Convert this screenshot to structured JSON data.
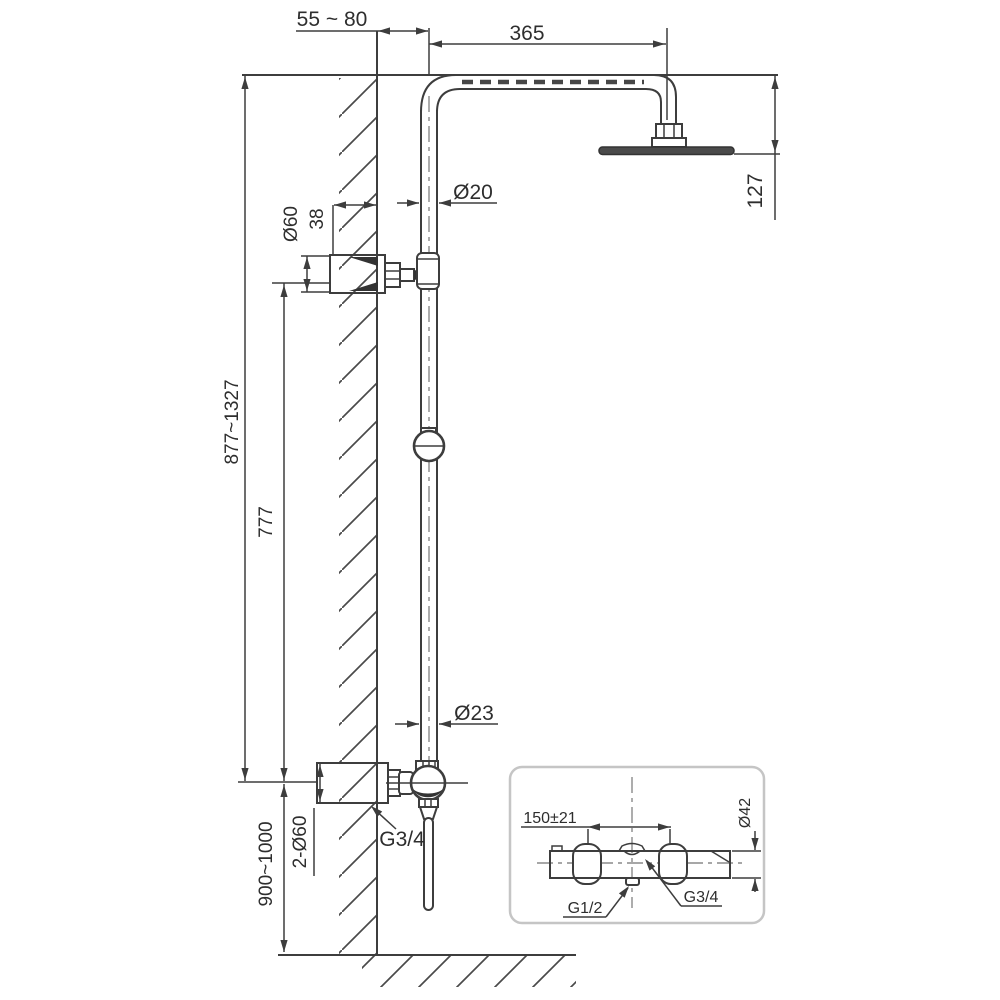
{
  "drawing": {
    "background": "#ffffff",
    "line_color": "#3d3d3d",
    "centerline_color": "#8a8a8a",
    "head_fill": "#4a4a4a",
    "inset_border_color": "#c5c5c5",
    "dimensions": {
      "wall_offset": "55 ~ 80",
      "arm_length": "365",
      "head_drop": "127",
      "pipe_upper_dia": "Ø20",
      "bracket_dia": "Ø60",
      "bracket_depth": "38",
      "riser_range": "877~1327",
      "bracket_spacing": "777",
      "pipe_lower_dia": "Ø23",
      "lower_thread": "G3/4",
      "escutcheons": "2-Ø60",
      "mount_height": "900~1000"
    },
    "inset": {
      "valve_spacing": "150±21",
      "body_dia": "Ø42",
      "bottom_outlet_thread": "G1/2",
      "top_outlet_thread": "G3/4"
    }
  }
}
